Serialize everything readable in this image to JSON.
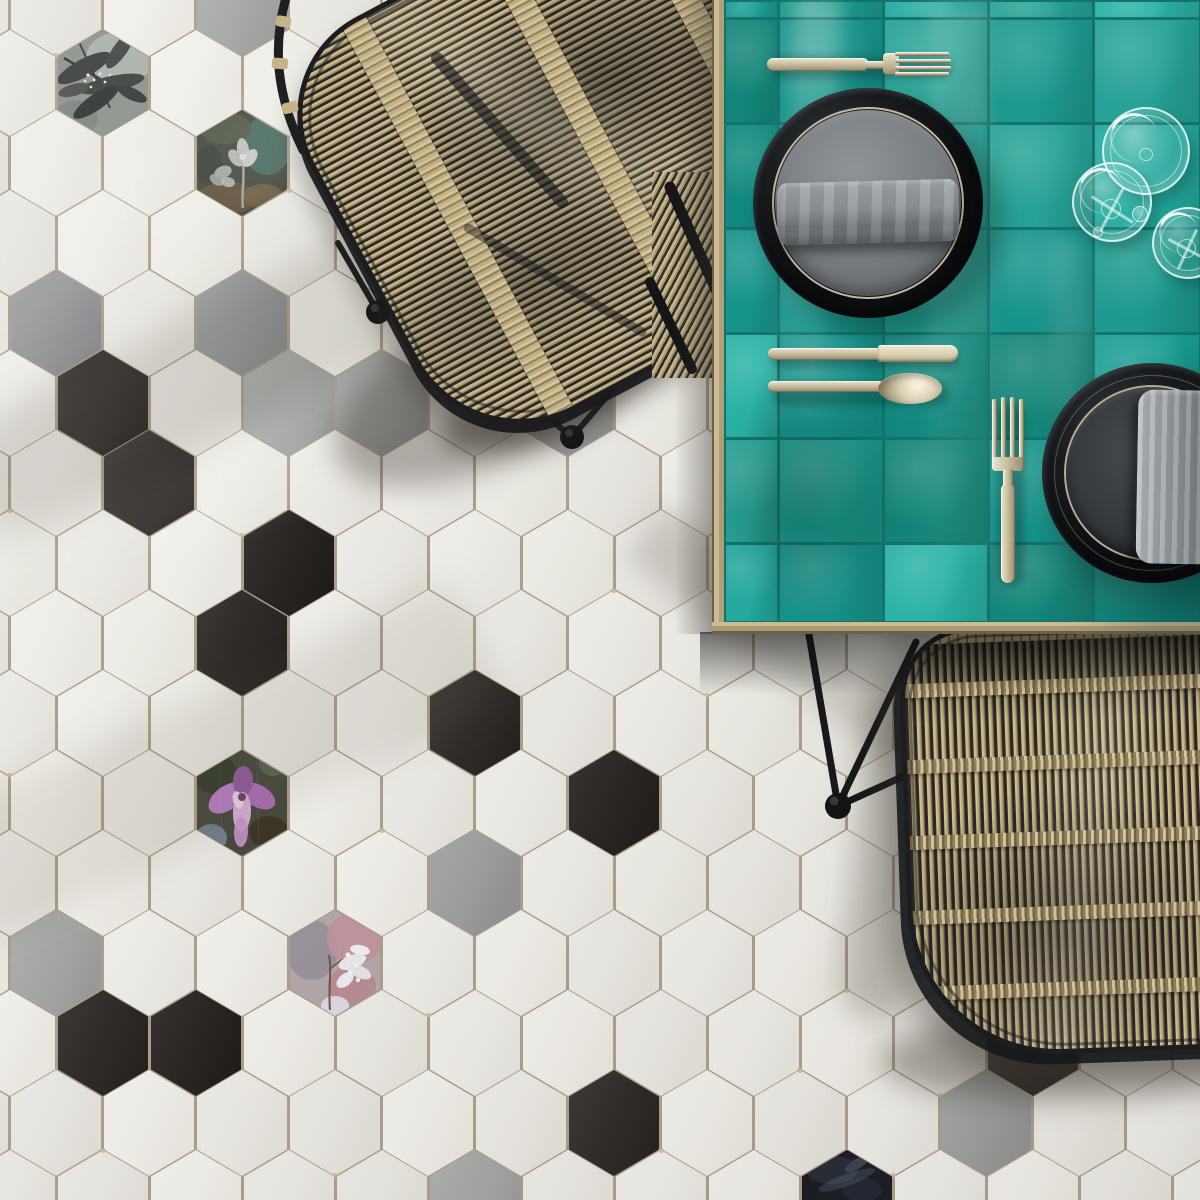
{
  "scene": {
    "type": "photograph",
    "subject": "Top-down view of a dining corner: hexagonal black, white, gray and floral-patterned floor tiles, a teal glazed-tile table with black plates, gray napkins, champagne cutlery and glasses, and two black-framed rattan chairs"
  },
  "palette": {
    "floor_grout": "#ab9f8d",
    "tile_black": "#2e2a27",
    "tile_gray": "#9c9e9d",
    "teal_grout": "#14736d",
    "wood_light": "#cdbc93",
    "wood_dark": "#6e6149",
    "frame_black": "#1b1d1f",
    "plate_black": "#0b0d0f",
    "plate_inner_gray": "#7c8185",
    "plate_inner_dark": "#35393d",
    "napkin_gray": "#8f9499",
    "cutlery_light": "#ece5cd",
    "cutlery_mid": "#c2b897",
    "cutlery_dark": "#978d70",
    "glass_rim": "#f2fcf9",
    "rattan_light": "#d3c498",
    "rattan_mid": "#c0af83"
  },
  "floor": {
    "grid": {
      "rows": 16,
      "first_row_y": 3,
      "row_pitch": 80,
      "col_pitch": 93,
      "even_row_x0": 56,
      "odd_row_x0": 10,
      "hex_w": 90,
      "hex_h": 106
    },
    "white_variants": [
      "#efede8",
      "#ebe9e3",
      "#f1efe9",
      "#e9e7e1",
      "#edece5"
    ],
    "gray_variants": [
      "#9c9e9d",
      "#a5a7a5",
      "#949697"
    ],
    "black_variants": [
      "#2e2a27",
      "#332f2c",
      "#282421"
    ],
    "special_tiles": [
      {
        "row": 0,
        "col": 2,
        "type": "gray"
      },
      {
        "row": 1,
        "col": 1,
        "type": "floral_leaves"
      },
      {
        "row": 2,
        "col": 2,
        "type": "floral_dark"
      },
      {
        "row": 4,
        "col": 0,
        "type": "gray"
      },
      {
        "row": 4,
        "col": 2,
        "type": "gray"
      },
      {
        "row": 4,
        "col": 7,
        "type": "black"
      },
      {
        "row": 5,
        "col": 1,
        "type": "black"
      },
      {
        "row": 5,
        "col": 3,
        "type": "gray"
      },
      {
        "row": 5,
        "col": 4,
        "type": "gray"
      },
      {
        "row": 5,
        "col": 6,
        "type": "gray"
      },
      {
        "row": 6,
        "col": 1,
        "type": "black"
      },
      {
        "row": 7,
        "col": 3,
        "type": "black"
      },
      {
        "row": 8,
        "col": 2,
        "type": "black"
      },
      {
        "row": 9,
        "col": 5,
        "type": "black"
      },
      {
        "row": 10,
        "col": 2,
        "type": "floral_orchid"
      },
      {
        "row": 10,
        "col": 6,
        "type": "black"
      },
      {
        "row": 11,
        "col": 5,
        "type": "gray"
      },
      {
        "row": 12,
        "col": 0,
        "type": "gray"
      },
      {
        "row": 12,
        "col": 3,
        "type": "floral_pale"
      },
      {
        "row": 13,
        "col": 1,
        "type": "black"
      },
      {
        "row": 13,
        "col": 2,
        "type": "black"
      },
      {
        "row": 13,
        "col": 11,
        "type": "black"
      },
      {
        "row": 14,
        "col": 6,
        "type": "black"
      },
      {
        "row": 14,
        "col": 10,
        "type": "gray"
      },
      {
        "row": 15,
        "col": 5,
        "type": "gray"
      },
      {
        "row": 15,
        "col": 9,
        "type": "floral_glossy"
      }
    ]
  },
  "table": {
    "teal_variants": [
      "#1b9e93",
      "#17948a",
      "#24aa9e",
      "#148579",
      "#2bb3a5",
      "#1d998d",
      "#11897e",
      "#27a296"
    ],
    "cols": 5,
    "rows": 7,
    "col_widths": [
      54,
      105,
      105,
      105,
      107
    ],
    "row_heights": [
      18,
      105,
      105,
      105,
      105,
      105,
      79
    ]
  },
  "tableware": {
    "plates": 2,
    "forks": 2,
    "knives": 1,
    "spoons": 1,
    "glasses": 3,
    "napkins": 2
  },
  "chairs": {
    "count": 2,
    "material": "rattan",
    "frame_color": "#1b1d1f"
  }
}
